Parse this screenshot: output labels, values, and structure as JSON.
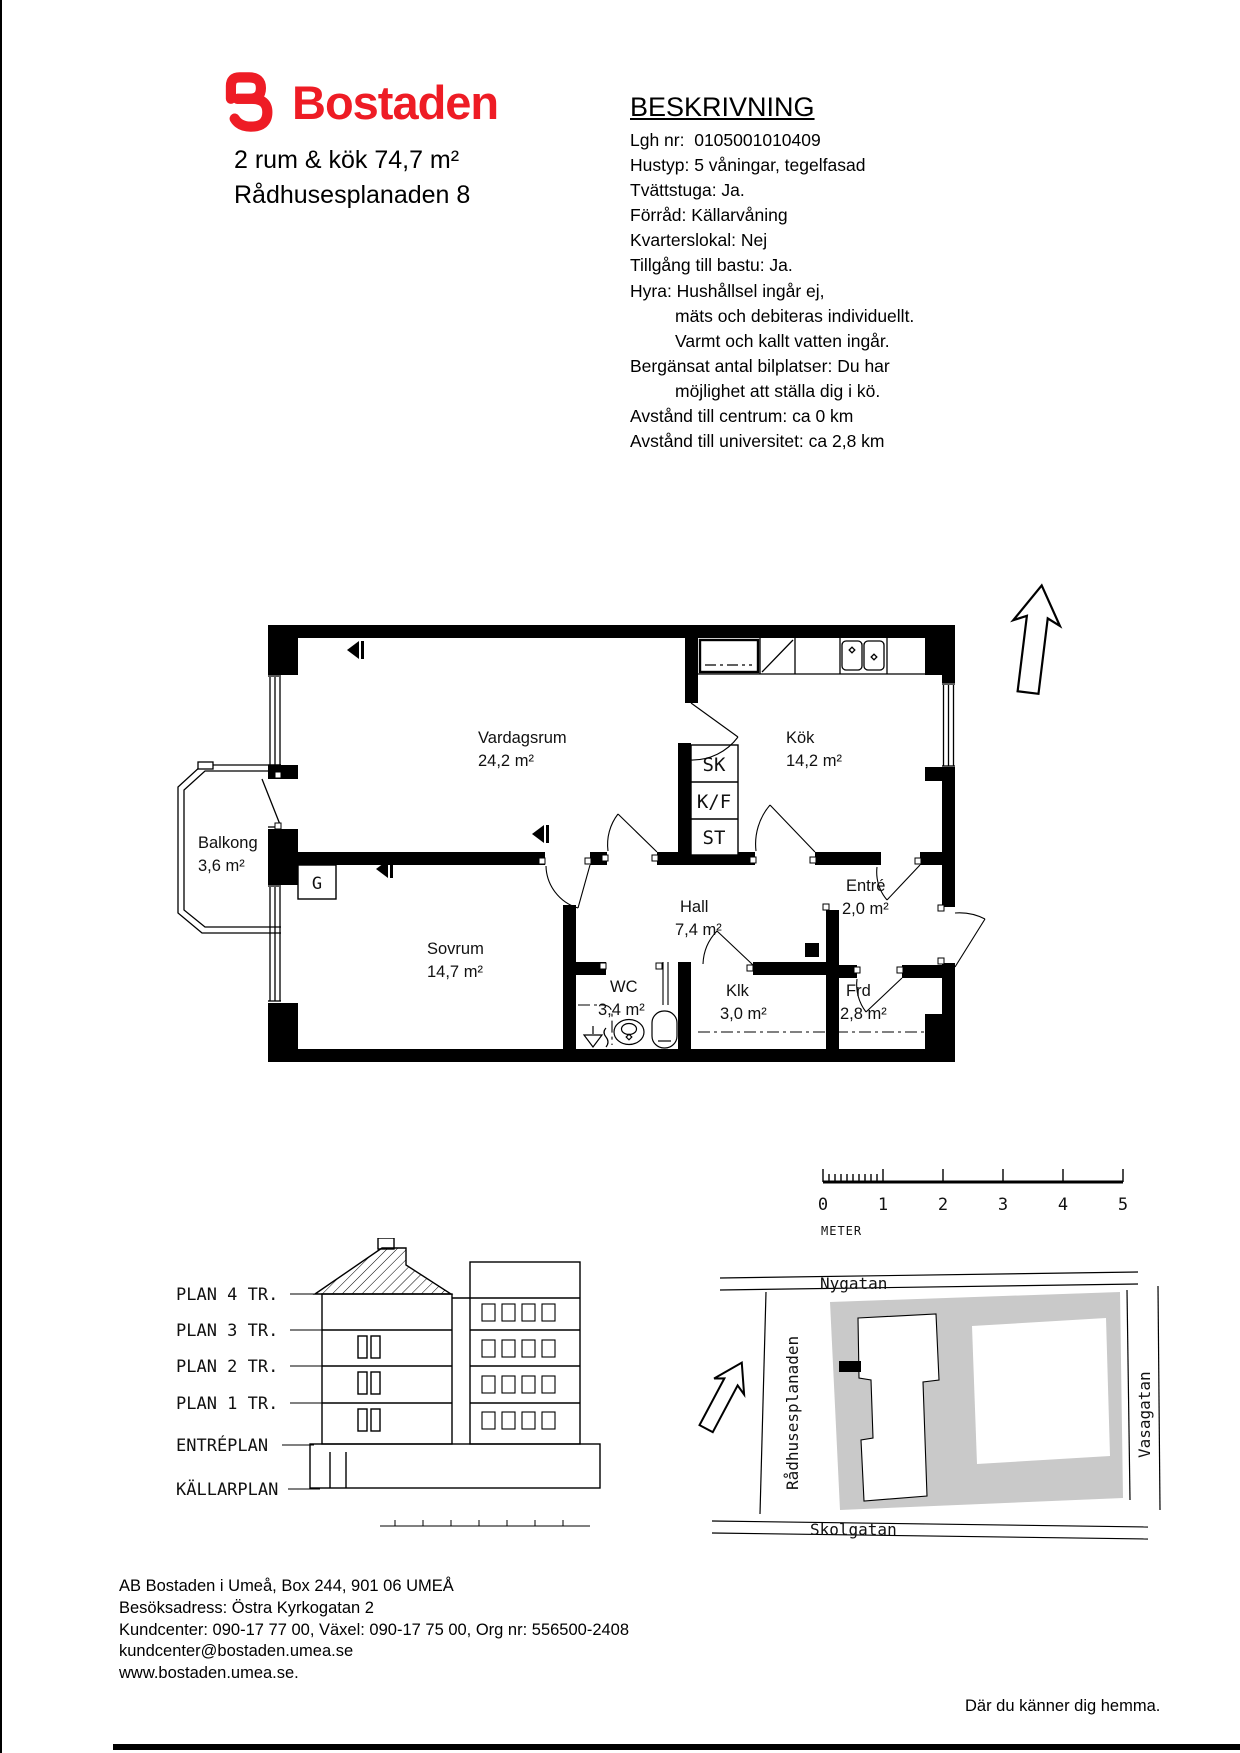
{
  "header": {
    "logo_text": "Bostaden",
    "brand_color": "#ee1c25",
    "apartment_summary": "2 rum & kök 74,7 m²",
    "address": "Rådhusesplanaden 8"
  },
  "description": {
    "title": "BESKRIVNING",
    "lines": [
      {
        "text": "Lgh nr:  0105001010409",
        "indent": false
      },
      {
        "text": "Hustyp: 5 våningar, tegelfasad",
        "indent": false
      },
      {
        "text": "Tvättstuga: Ja.",
        "indent": false
      },
      {
        "text": "Förråd: Källarvåning",
        "indent": false
      },
      {
        "text": "Kvarterslokal: Nej",
        "indent": false
      },
      {
        "text": "Tillgång till bastu: Ja.",
        "indent": false
      },
      {
        "text": "Hyra: Hushållsel ingår ej,",
        "indent": false
      },
      {
        "text": "mäts och debiteras individuellt.",
        "indent": true
      },
      {
        "text": "Varmt och kallt vatten ingår.",
        "indent": true
      },
      {
        "text": "Bergänsat antal bilplatser: Du har",
        "indent": false
      },
      {
        "text": "möjlighet att ställa dig i kö.",
        "indent": true
      },
      {
        "text": "Avstånd till centrum: ca 0 km",
        "indent": false
      },
      {
        "text": "Avstånd till universitet: ca 2,8 km",
        "indent": false
      }
    ]
  },
  "floorplan": {
    "rooms": [
      {
        "name": "Vardagsrum",
        "area": "24,2 m²"
      },
      {
        "name": "Kök",
        "area": "14,2 m²"
      },
      {
        "name": "Balkong",
        "area": "3,6 m²"
      },
      {
        "name": "Sovrum",
        "area": "14,7 m²"
      },
      {
        "name": "Hall",
        "area": "7,4 m²"
      },
      {
        "name": "Entré",
        "area": "2,0 m²"
      },
      {
        "name": "WC",
        "area": "3,4 m²"
      },
      {
        "name": "Klk",
        "area": "3,0 m²"
      },
      {
        "name": "Frd",
        "area": "2,8 m²"
      }
    ],
    "closets": [
      "SK",
      "K/F",
      "ST",
      "G"
    ]
  },
  "scalebar": {
    "ticks": [
      "0",
      "1",
      "2",
      "3",
      "4",
      "5"
    ],
    "unit": "METER"
  },
  "section": {
    "levels": [
      "PLAN 4 TR.",
      "PLAN 3 TR.",
      "PLAN 2 TR.",
      "PLAN 1 TR.",
      "ENTRÉPLAN",
      "KÄLLARPLAN"
    ]
  },
  "siteplan": {
    "streets": {
      "top": "Nygatan",
      "left": "Rådhusesplanaden",
      "right": "Vasagatan",
      "bottom": "Skolgatan"
    },
    "block_color": "#c9c9c9"
  },
  "footer": {
    "lines": [
      "AB Bostaden i Umeå, Box 244, 901 06 UMEÅ",
      "Besöksadress: Östra Kyrkogatan 2",
      "Kundcenter: 090-17 77 00, Växel: 090-17 75 00, Org nr: 556500-2408",
      "kundcenter@bostaden.umea.se",
      "www.bostaden.umea.se."
    ],
    "slogan": "Där du känner dig hemma."
  }
}
